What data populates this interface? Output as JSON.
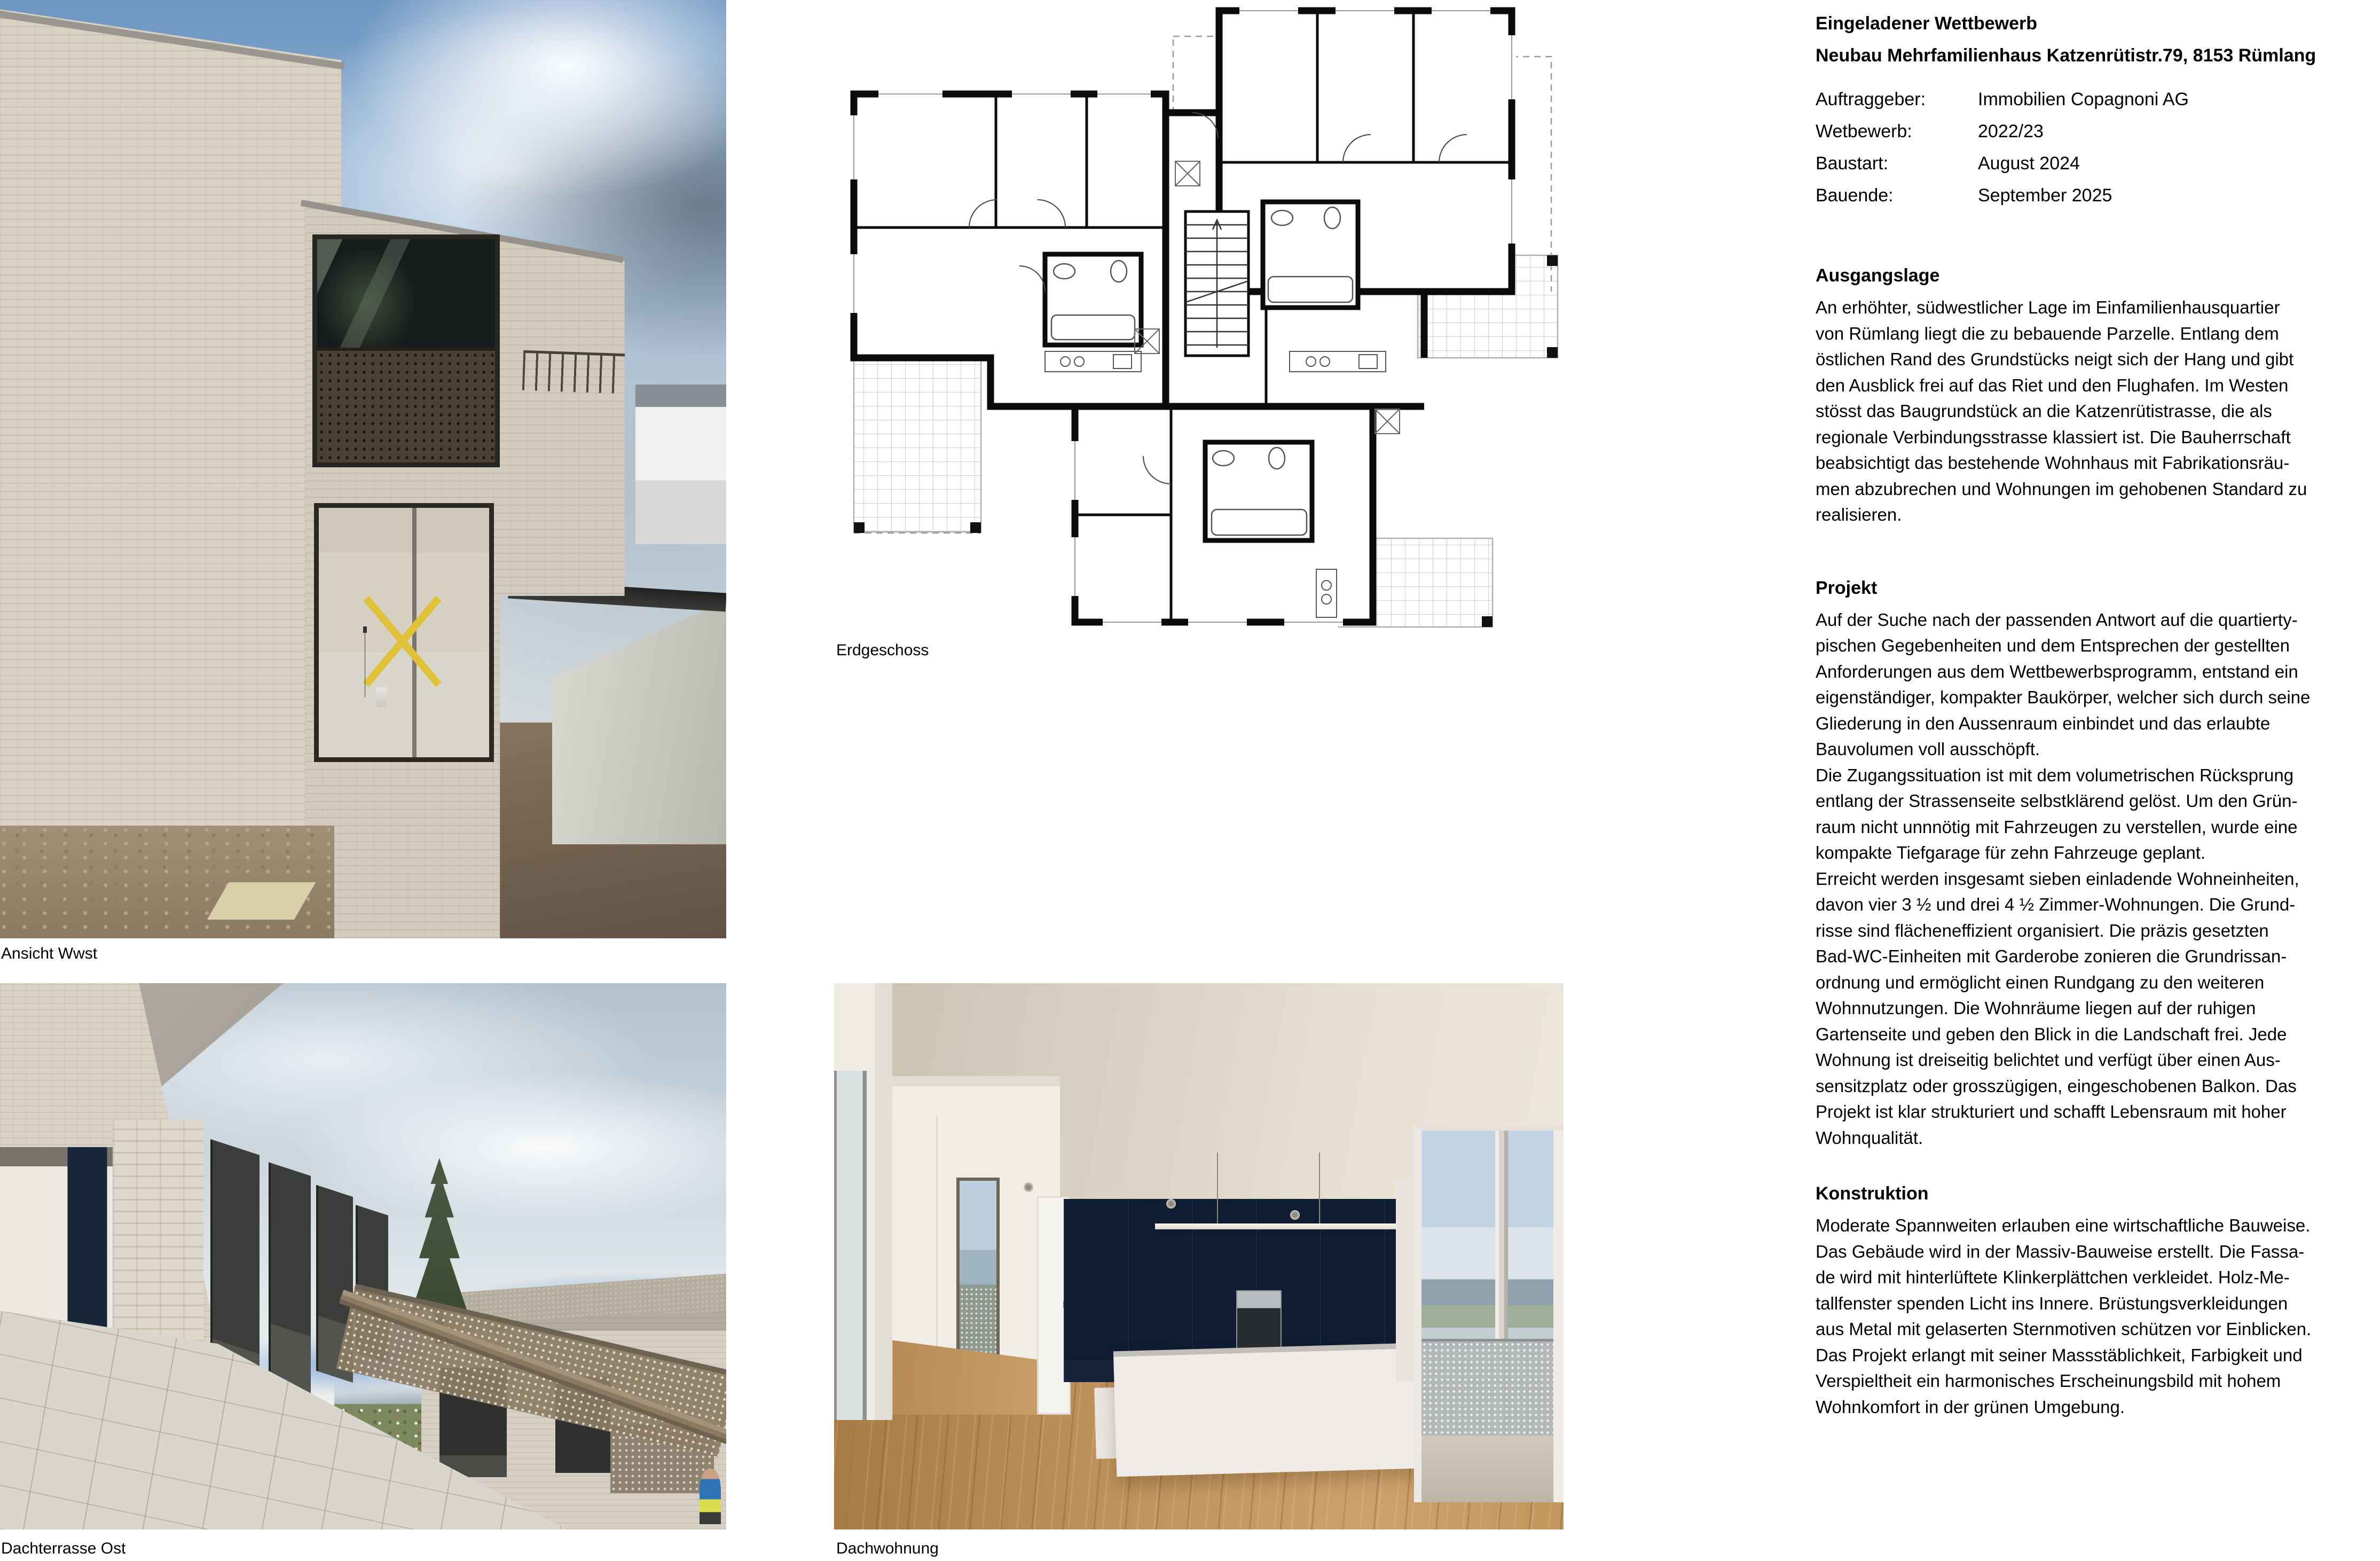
{
  "header": {
    "title_line1": "Eingeladener Wettbewerb",
    "title_line2": "Neubau Mehrfamilienhaus Katzenrütistr.79, 8153 Rümlang",
    "meta": [
      {
        "label": "Auftraggeber:",
        "value": "Immobilien Copagnoni AG"
      },
      {
        "label": "Wetbewerb:",
        "value": "2022/23"
      },
      {
        "label": "Baustart:",
        "value": "August 2024"
      },
      {
        "label": "Bauende:",
        "value": "September 2025"
      }
    ]
  },
  "sections": {
    "ausgangslage": {
      "heading": "Ausgangslage",
      "body": "An erhöhter, südwestlicher Lage im Einfamilienhausquartier\nvon Rümlang liegt die zu bebauende Parzelle. Entlang dem\nöstlichen Rand des Grundstücks neigt sich der Hang und gibt\nden Ausblick frei auf das Riet und den Flughafen. Im Westen\nstösst das Baugrundstück an die Katzenrütistrasse, die als\nregionale Verbindungsstrasse klassiert ist. Die Bauherrschaft\nbeabsichtigt das bestehende Wohnhaus mit Fabrikationsräu-\nmen abzubrechen und Wohnungen im gehobenen Standard zu\nrealisieren."
    },
    "projekt": {
      "heading": "Projekt",
      "body": "Auf der Suche nach der passenden Antwort auf die quartierty-\npischen Gegebenheiten und dem Entsprechen der gestellten\nAnforderungen aus dem Wettbewerbsprogramm, entstand ein\neigenständiger, kompakter Baukörper, welcher sich durch seine\nGliederung in den Aussenraum einbindet und das erlaubte\nBauvolumen voll ausschöpft.\nDie Zugangssituation ist mit dem volumetrischen Rücksprung\nentlang der Strassenseite selbstklärend gelöst. Um den Grün-\nraum nicht unnnötig mit Fahrzeugen zu verstellen, wurde eine\nkompakte Tiefgarage für zehn Fahrzeuge geplant.\nErreicht werden insgesamt sieben einladende Wohneinheiten,\ndavon vier 3 ½ und drei 4 ½ Zimmer-Wohnungen. Die Grund-\nrisse sind flächeneffizient organisiert. Die präzis gesetzten\nBad-WC-Einheiten mit Garderobe zonieren die Grundrissan-\nordnung und ermöglicht einen Rundgang zu den weiteren\nWohnnutzungen. Die Wohnräume liegen auf der ruhigen\nGartenseite und geben den Blick in die Landschaft frei. Jede\nWohnung ist dreiseitig belichtet und verfügt über einen Aus-\nsensitzplatz oder grosszügigen, eingeschobenen Balkon. Das\nProjekt ist klar strukturiert und schafft Lebensraum mit hoher\nWohnqualität."
    },
    "konstruktion": {
      "heading": "Konstruktion",
      "body": "Moderate Spannweiten erlauben eine wirtschaftliche Bauweise.\nDas Gebäude wird in der Massiv-Bauweise erstellt. Die Fassa-\nde wird mit hinterlüftete Klinkerplättchen verkleidet. Holz-Me-\ntallfenster spenden Licht ins Innere. Brüstungsverkleidungen\naus Metal mit gelaserten Sternmotiven schützen vor Einblicken.\nDas Projekt erlangt mit seiner Massstäblichkeit, Farbigkeit und\nVerspieltheit ein harmonisches Erscheinungsbild mit hohem\nWohnkomfort in der grünen Umgebung."
    }
  },
  "figures": {
    "ansicht": {
      "caption": "Ansicht Wwst"
    },
    "erdgeschoss": {
      "caption": "Erdgeschoss"
    },
    "terrasse": {
      "caption": "Dachterrasse Ost"
    },
    "dachwohnung": {
      "caption": "Dachwohnung"
    }
  },
  "palette": {
    "page_bg": "#ffffff",
    "text": "#000000",
    "plan_wall": "#0b0b0b",
    "brick_facade": "#d6cfc2",
    "sky_blue": "#7fa3cc",
    "cloud_gray": "#8c9aa6",
    "earth_brown": "#6f5f4b",
    "bronze_metal": "#6e604c",
    "navy_wall": "#101d33",
    "oak_floor": "#bd9059",
    "terrace_tile": "#d8d4ca",
    "landscape_green": "#74855c"
  }
}
